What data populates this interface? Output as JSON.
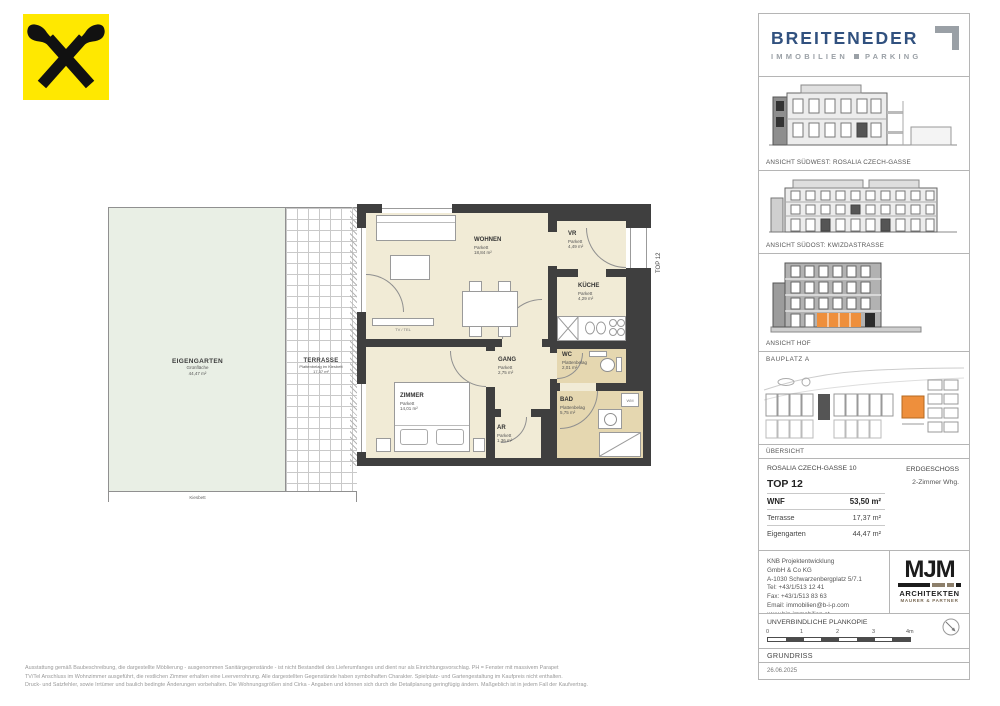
{
  "branding": {
    "breiteneder": {
      "name": "BREITENEDER",
      "tagline_left": "IMMOBILIEN",
      "tagline_right": "PARKING"
    },
    "mjm": {
      "name": "MJM",
      "line1": "ARCHITEKTEN",
      "line2": "MAURER & PARTNER"
    }
  },
  "floorplan": {
    "unit_tag": "TOP 12",
    "rooms": [
      {
        "name": "WOHNEN",
        "finish": "Parkett",
        "area": "18,84 m²"
      },
      {
        "name": "ZIMMER",
        "finish": "Parkett",
        "area": "14,01 m²"
      },
      {
        "name": "VR",
        "finish": "Parkett",
        "area": "4,49 m²"
      },
      {
        "name": "KÜCHE",
        "finish": "Parkett",
        "area": "4,29 m²"
      },
      {
        "name": "GANG",
        "finish": "Parkett",
        "area": "2,75 m²"
      },
      {
        "name": "WC",
        "finish": "Plattenbelag",
        "area": "2,01 m²"
      },
      {
        "name": "BAD",
        "finish": "Plattenbelag",
        "area": "5,75 m²"
      },
      {
        "name": "AR",
        "finish": "Parkett",
        "area": "1,36 m²"
      }
    ],
    "outdoor": [
      {
        "name": "EIGENGARTEN",
        "finish": "Grünfläche",
        "area": "44,47 m²"
      },
      {
        "name": "TERRASSE",
        "finish": "Plattenbelag im Kiesbett",
        "area": "17,37 m²"
      }
    ],
    "labels": {
      "kiesbett": "Kiesbett",
      "tv_tel": "TV / TEL",
      "wm": "WM"
    }
  },
  "panel": {
    "elevations": [
      {
        "caption": "ANSICHT SÜDWEST: ROSALIA CZECH-GASSE"
      },
      {
        "caption": "ANSICHT SÜDOST: KWIZDASTRASSE"
      },
      {
        "caption": "ANSICHT HOF"
      }
    ],
    "siteplan": {
      "title": "BAUPLATZ  A",
      "caption": "ÜBERSICHT"
    },
    "info": {
      "address": "ROSALIA CZECH-GASSE 10",
      "floor": "ERDGESCHOSS",
      "unit": "TOP 12",
      "unit_type": "2-Zimmer Whg.",
      "wnf_label": "WNF",
      "wnf_value": "53,50 m²",
      "terrasse_label": "Terrasse",
      "terrasse_value": "17,37 m²",
      "garten_label": "Eigengarten",
      "garten_value": "44,47 m²"
    },
    "contact": {
      "line0": "KNB Projektentwicklung",
      "line1": "GmbH & Co KG",
      "line2": "A-1030 Schwarzenbergplatz 5/7.1",
      "line3": "Tel: +43/1/513 12 41",
      "line4": "Fax: +43/1/513 83 63",
      "line5": "Email: immobilien@b-i-p.com",
      "line6": "www.bip-immobilien.at"
    },
    "plan_copy": "UNVERBINDLICHE PLANKOPIE",
    "scale_ticks": [
      "0",
      "1",
      "2",
      "3",
      "4m"
    ],
    "drawing_type": "GRUNDRISS",
    "date": "26.06.2025"
  },
  "disclaimer": {
    "line0": "Ausstattung gemäß Baubeschreibung, die dargestellte Möblierung - ausgenommen Sanitärgegenstände - ist nicht Bestandteil des Lieferumfanges und dient nur als Einrichtungsvorschlag. PH = Fenster mit massivem Parapet",
    "line1": "TV/Tel Anschluss im Wohnzimmer ausgeführt, die restlichen Zimmer erhalten eine Leerverrohrung. Alle dargestellten Gegenstände haben symbolhaften Charakter. Spielplatz- und Gartengestaltung im Kaufpreis nicht enthalten.",
    "line2": "Druck- und Satzfehler, sowie Irrtümer und baulich bedingte Änderungen vorbehalten. Die Wohnungsgrößen sind Cirka - Angaben und können sich durch die Detailplanung geringfügig ändern. Maßgeblich ist in jedem Fall der Kaufvertrag."
  },
  "colors": {
    "accent_orange": "#ee8f3c",
    "wall": "#3f3f3f",
    "room_beige": "#f1ebd6",
    "room_tile": "#e5d7b0",
    "garden": "#e9efe5",
    "brand_blue": "#31517f",
    "raiffeisen_yellow": "#ffe800"
  }
}
